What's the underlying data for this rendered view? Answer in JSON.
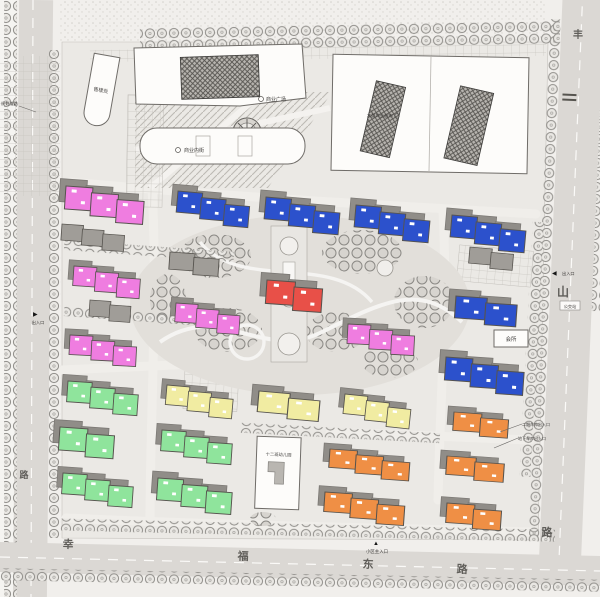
{
  "roads": {
    "left": {
      "name_chars": [
        "路"
      ]
    },
    "bottom": {
      "name_chars": [
        "幸",
        "福",
        "东",
        "路"
      ]
    },
    "right": {
      "name_chars": [
        "丰",
        "山",
        "路"
      ]
    }
  },
  "buildings": {
    "supermarket_label": "大型商业超市",
    "inner_street_label": "商业内街",
    "sales_office_label": "售楼处",
    "plaza_label": "商业广场",
    "kindergarten_label": "十二班幼儿园",
    "club_label": "会所"
  },
  "annotations": {
    "garage_entrance_1": "二期车库出入口",
    "garage_entrance_2": "地下车库出入口",
    "bus_stop": "公交站",
    "road_note": "规划道路",
    "entrance_left": "出入口",
    "entrance_right": "出入口",
    "main_entrance": "小区主入口"
  },
  "markers": {
    "arrow_right": "▶",
    "arrow_left": "◀",
    "arrow_up": "▲"
  },
  "legend_colors": {
    "pink": "#ef7de0",
    "blue": "#2c51cc",
    "red": "#e85048",
    "green": "#8fe49c",
    "yellow": "#f1eca2",
    "orange": "#ef8f45",
    "road": "#dbd8d4",
    "site": "#ebe9e5",
    "shadow": "#908d88"
  }
}
